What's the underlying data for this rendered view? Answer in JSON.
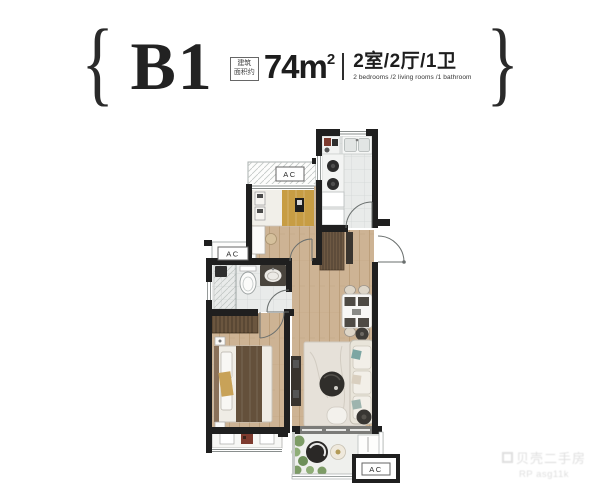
{
  "header": {
    "brace_left": "{",
    "brace_right": "}",
    "plan_code": "B1",
    "area_note_line1": "建筑",
    "area_note_line2": "面积约",
    "area_value": "74m",
    "area_sup": "2",
    "layout_cn": "2室/2厅/1卫",
    "layout_en": "2 bedrooms /2 living rooms /1 bathroom"
  },
  "floorplan": {
    "labels": {
      "ac": "AC"
    }
  },
  "watermark": {
    "line1": "贝壳二手房",
    "line2": "RP asg11k"
  },
  "colors": {
    "wall": "#1f1f1f",
    "wood_floor": "#cdb394",
    "tile_floor": "#e9ebea",
    "bed2_blanket_mustard": "#c79d44",
    "master_blanket_brown": "#64503b",
    "wardrobe_brown": "#6b563f",
    "sofa_cream": "#e9e5da",
    "cushion_teal": "#7ca6a3",
    "dark_furniture": "#302e2b",
    "rug": "#e6e1d9",
    "plant_green": "#7d9c66",
    "vanity_dark": "#4a453e",
    "accent_red": "#7e3b2f"
  }
}
